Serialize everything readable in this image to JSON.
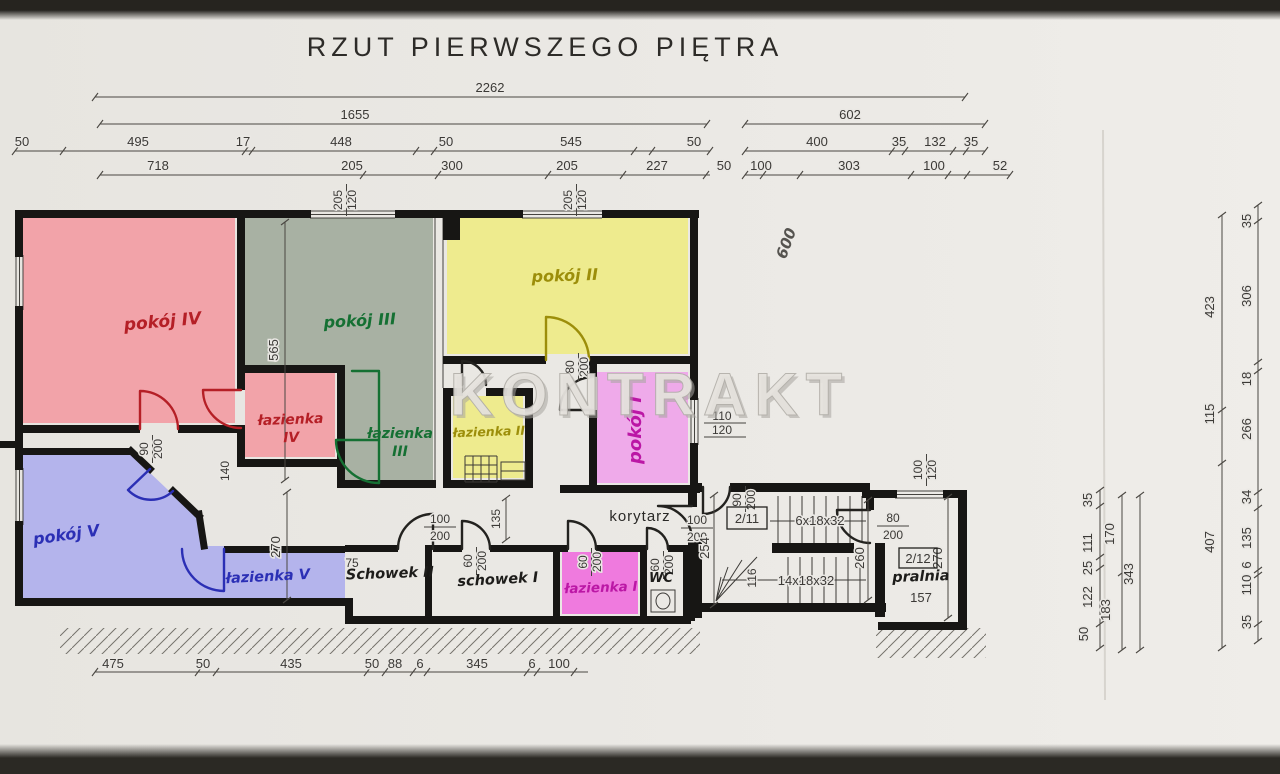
{
  "page": {
    "title": "RZUT PIERWSZEGO PIĘTRA",
    "watermark": "KONTRAKT",
    "handwritten_note": "600"
  },
  "rooms": {
    "pokoj_iv": "pokój IV",
    "pokoj_iii": "pokój III",
    "pokoj_ii": "pokój II",
    "pokoj_i": "pokój I",
    "pokoj_v": "pokój V",
    "lazienka_iv": [
      "łazienka",
      "IV"
    ],
    "lazienka_iii": [
      "łazienka",
      "III"
    ],
    "lazienka_ii": "łazienka II",
    "lazienka_i": "łazienka I",
    "lazienka_v": "łazienka V",
    "schowek_ii": "Schowek II",
    "schowek_i": "schowek I",
    "wc": "WC",
    "korytarz": "korytarz",
    "pralnia": "pralnia"
  },
  "stairs": {
    "upper_run": "6x18x32",
    "lower_run": "14x18x32",
    "tag_upper": "2/11",
    "tag_lower": "2/12",
    "pralnia_number": "157"
  },
  "dims": {
    "top_total": [
      "2262"
    ],
    "top_row2": [
      "1655",
      "602"
    ],
    "top_row3": [
      "50",
      "495",
      "17",
      "448",
      "50",
      "545",
      "50",
      "400",
      "35",
      "132",
      "35"
    ],
    "top_row4": [
      "718",
      "205",
      "300",
      "205",
      "227",
      "50",
      "100",
      "303",
      "100",
      "52"
    ],
    "bottom": [
      "475",
      "50",
      "435",
      "50",
      "88",
      "6",
      "345",
      "6",
      "100"
    ],
    "right_outer": [
      "35",
      "306",
      "18",
      "266",
      "34",
      "135",
      "6",
      "110",
      "35"
    ],
    "right_mid": [
      "423",
      "115",
      "407"
    ],
    "right_inner": [
      "35",
      "111",
      "25",
      "122",
      "50"
    ],
    "right_inner2": [
      "170",
      "183"
    ],
    "right_inner3": [
      "343"
    ],
    "v565": "565",
    "v270_a": "270",
    "v270_b": "270",
    "v260": "260",
    "v254": "254",
    "v140": "140",
    "v135": "135",
    "v116": "116",
    "v75": "75"
  },
  "windows": {
    "top_a": [
      "205",
      "120"
    ],
    "top_b": [
      "205",
      "120"
    ],
    "right": [
      "110",
      "120"
    ],
    "pralnia": [
      "100",
      "120"
    ]
  },
  "doors": {
    "d90_a": [
      "90",
      "200"
    ],
    "d90_b": [
      "90",
      "200"
    ],
    "d80_a": [
      "80",
      "200"
    ],
    "d80_b": [
      "80",
      "200"
    ],
    "d100_a": [
      "100",
      "200"
    ],
    "d100_b": [
      "100",
      "200"
    ],
    "d60_a": [
      "60",
      "200"
    ],
    "d60_b": [
      "60",
      "200"
    ],
    "d60_c": [
      "60",
      "200"
    ]
  },
  "colors": {
    "room_pink": "#f2a3a9",
    "room_green": "#a8b1a3",
    "room_yellow": "#eeeb8e",
    "room_magenta": "#efaaea",
    "room_magenta_bright": "#ef7ade",
    "room_blue": "#b4b4ec",
    "label_red": "#b51f26",
    "label_green": "#157033",
    "label_olive": "#9c8e0a",
    "label_magenta": "#bb17a5",
    "label_blue": "#2b2fb5",
    "ink": "#3b3936",
    "wall": "#171614"
  }
}
